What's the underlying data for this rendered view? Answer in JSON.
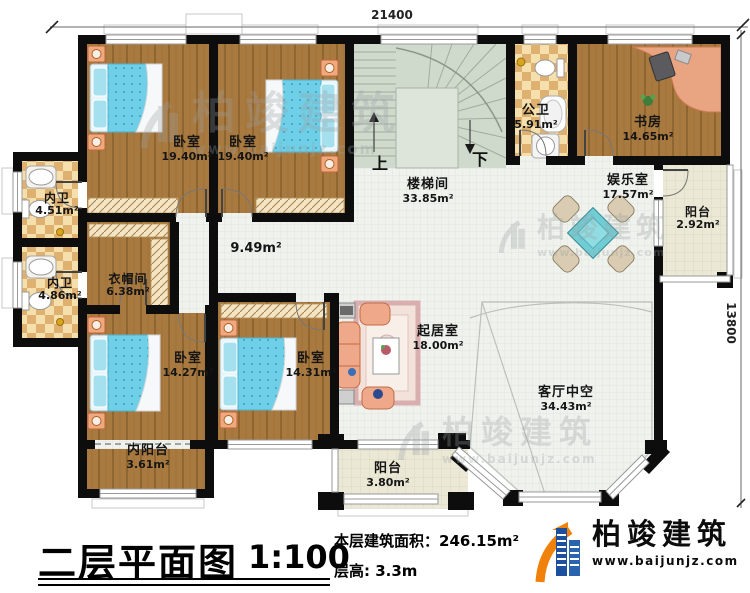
{
  "title_block": {
    "title": "二层平面图",
    "scale": "1:100",
    "area_label": "本层建筑面积：",
    "area_value": "246.15m²",
    "height_label": "层高:",
    "height_value": "3.3m"
  },
  "brand": {
    "name": "柏竣建筑",
    "url": "www.baijunjz.com"
  },
  "watermark": {
    "name": "柏竣建筑",
    "url": "www.baijunjz.com"
  },
  "dimensions": {
    "width": "21400",
    "height": "13800"
  },
  "stair": {
    "up": "上",
    "down": "下"
  },
  "hall": {
    "area": "9.49m²"
  },
  "rooms": {
    "bedroom_tl": {
      "name": "卧室",
      "area": "19.40m²"
    },
    "bedroom_tm": {
      "name": "卧室",
      "area": "19.40m²"
    },
    "stair_hall": {
      "name": "楼梯间",
      "area": "33.85m²"
    },
    "public_bath": {
      "name": "公卫",
      "area": "5.91m²"
    },
    "study": {
      "name": "书房",
      "area": "14.65m²"
    },
    "entertainment": {
      "name": "娱乐室",
      "area": "17.57m²"
    },
    "balcony_east": {
      "name": "阳台",
      "area": "2.92m²"
    },
    "bath_north": {
      "name": "内卫",
      "area": "4.51m²"
    },
    "bath_south": {
      "name": "内卫",
      "area": "4.86m²"
    },
    "cloakroom": {
      "name": "衣帽间",
      "area": "6.38m²"
    },
    "bedroom_bl": {
      "name": "卧室",
      "area": "14.27m²"
    },
    "bedroom_bm": {
      "name": "卧室",
      "area": "14.31m²"
    },
    "inner_balcony": {
      "name": "内阳台",
      "area": "3.61m²"
    },
    "living": {
      "name": "起居室",
      "area": "18.00m²"
    },
    "living_void": {
      "name": "客厅中空",
      "area": "34.43m²"
    },
    "balcony_south": {
      "name": "阳台",
      "area": "3.80m²"
    }
  },
  "colors": {
    "wall": "#0d0d0d",
    "wood_floor": "#a97a40",
    "stair_floor": "#cfd9cc",
    "hall_floor": "#f0f2ee",
    "bath_tile_light": "#f4dfad",
    "bath_tile_dark": "#dfb171",
    "balcony_tile": "#ebe8d6",
    "bed_blue": "#6fcfe7",
    "sofa_salmon": "#efa88a",
    "logo_blue": "#1c4f9d",
    "logo_orange": "#f0820c"
  }
}
